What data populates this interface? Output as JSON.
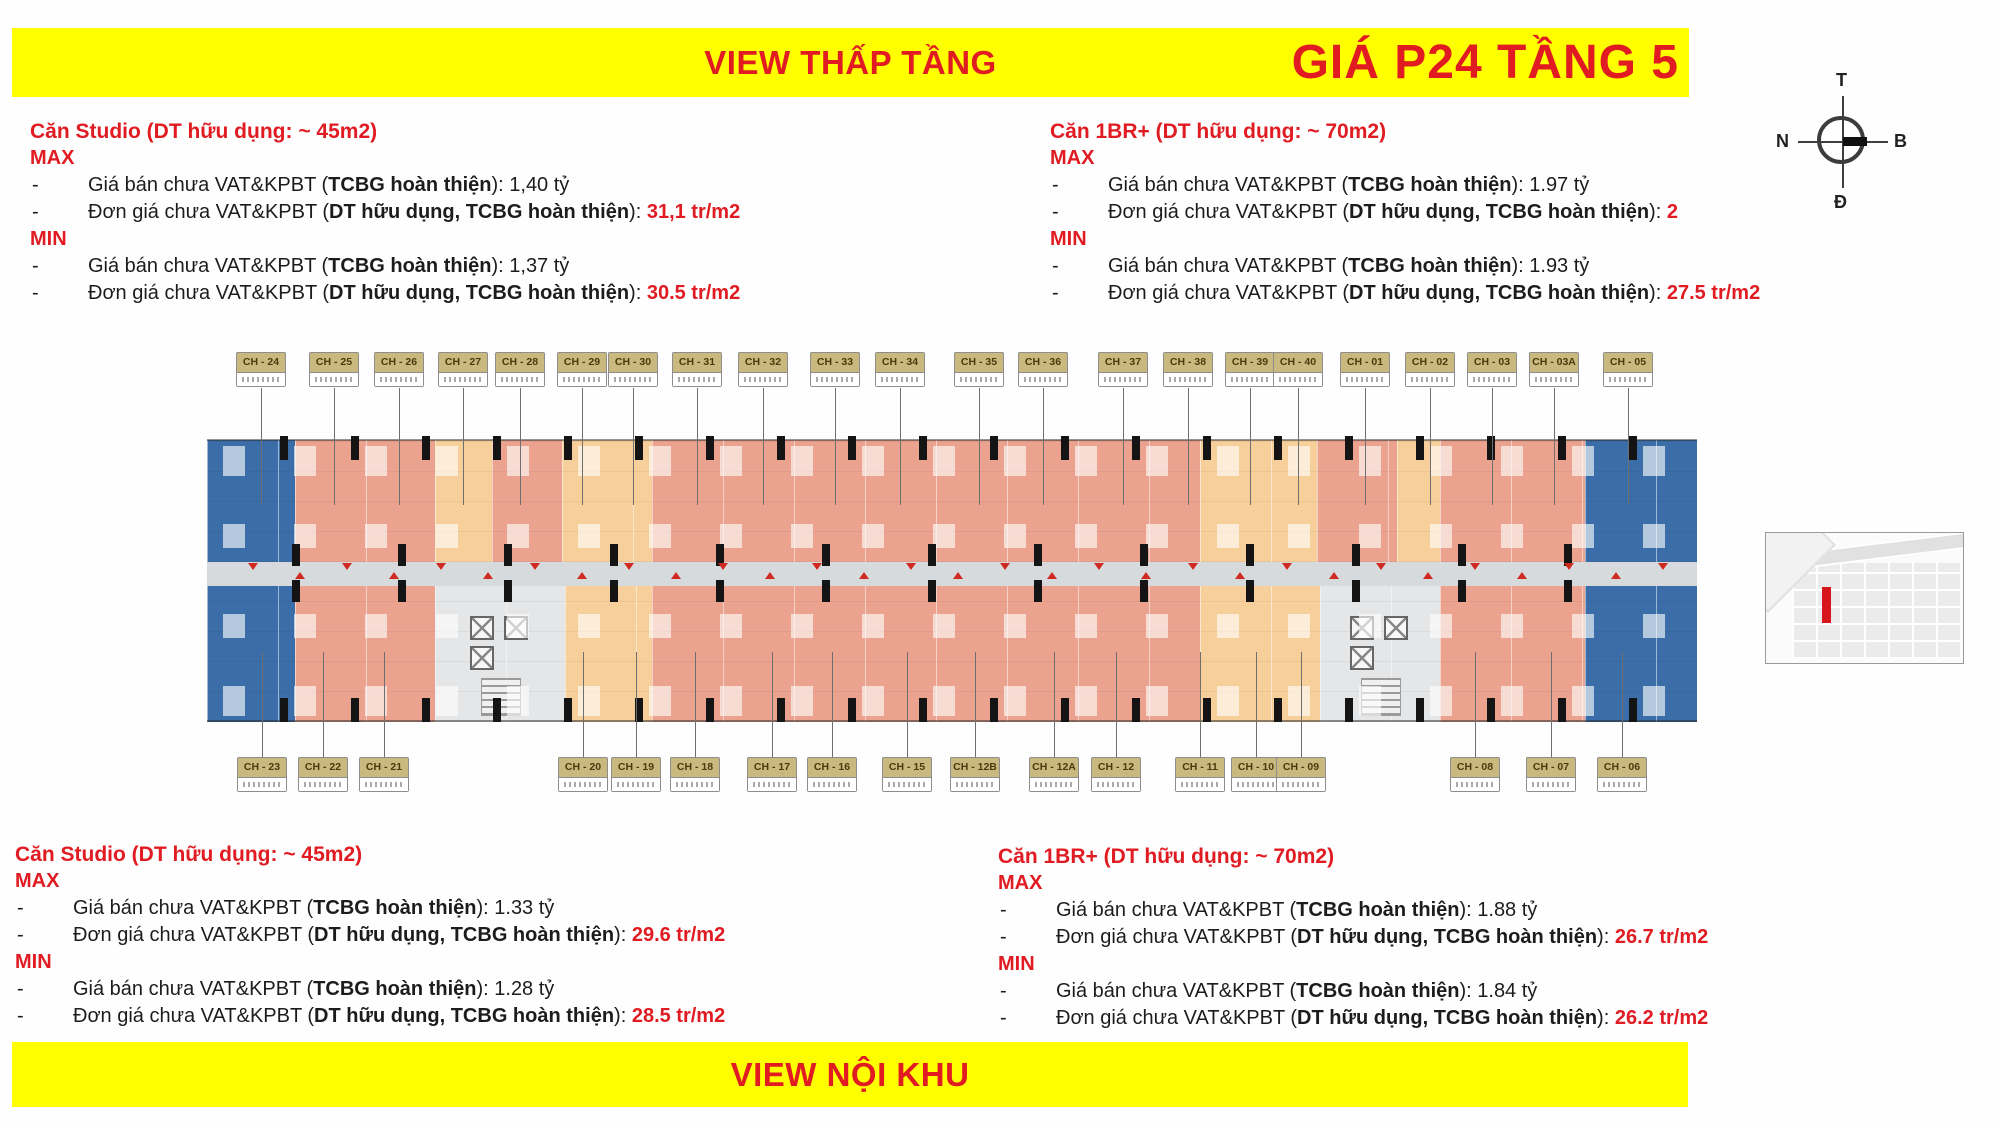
{
  "banners": {
    "top_center": "VIEW THẤP TẦNG",
    "top_right": "GIÁ P24 TẦNG 5",
    "bottom_center": "VIEW NỘI KHU"
  },
  "compass": {
    "top": "T",
    "bottom": "Đ",
    "left": "N",
    "right": "B"
  },
  "pricing": {
    "bullet": "-",
    "blocks": [
      {
        "pos": "tl",
        "title": "Căn Studio (DT hữu dụng: ~ 45m2)",
        "groups": [
          {
            "label": "MAX",
            "rows": [
              [
                [
                  "Giá bán chưa VAT&KPBT (",
                  ""
                ],
                [
                  "TCBG hoàn thiện",
                  "b"
                ],
                [
                  "): 1,40 tỷ",
                  ""
                ]
              ],
              [
                [
                  "Đơn giá chưa VAT&KPBT (",
                  ""
                ],
                [
                  "DT hữu dụng, TCBG hoàn thiện",
                  "b"
                ],
                [
                  "): ",
                  ""
                ],
                [
                  "31,1 tr/m2",
                  "r"
                ]
              ]
            ]
          },
          {
            "label": "MIN",
            "rows": [
              [
                [
                  "Giá bán chưa VAT&KPBT (",
                  ""
                ],
                [
                  "TCBG hoàn thiện",
                  "b"
                ],
                [
                  "): 1,37 tỷ",
                  ""
                ]
              ],
              [
                [
                  "Đơn giá chưa VAT&KPBT (",
                  ""
                ],
                [
                  "DT hữu dụng, TCBG hoàn thiện",
                  "b"
                ],
                [
                  "): ",
                  ""
                ],
                [
                  "30.5 tr/m2",
                  "r"
                ]
              ]
            ]
          }
        ]
      },
      {
        "pos": "tr",
        "title": "Căn 1BR+ (DT hữu dụng: ~ 70m2)",
        "groups": [
          {
            "label": "MAX",
            "rows": [
              [
                [
                  "Giá bán chưa VAT&KPBT (",
                  ""
                ],
                [
                  "TCBG hoàn thiện",
                  "b"
                ],
                [
                  "): 1.97 tỷ",
                  ""
                ]
              ],
              [
                [
                  "Đơn giá chưa VAT&KPBT (",
                  ""
                ],
                [
                  "DT hữu dụng, TCBG hoàn thiện",
                  "b"
                ],
                [
                  "): ",
                  ""
                ],
                [
                  "2",
                  "r"
                ]
              ]
            ]
          },
          {
            "label": "MIN",
            "rows": [
              [
                [
                  "Giá bán chưa VAT&KPBT (",
                  ""
                ],
                [
                  "TCBG hoàn thiện",
                  "b"
                ],
                [
                  "): 1.93 tỷ",
                  ""
                ]
              ],
              [
                [
                  "Đơn giá chưa VAT&KPBT (",
                  ""
                ],
                [
                  "DT hữu dụng, TCBG hoàn thiện",
                  "b"
                ],
                [
                  "): ",
                  ""
                ],
                [
                  "27.5 tr/m2",
                  "r"
                ]
              ]
            ]
          }
        ]
      },
      {
        "pos": "bl",
        "title": "Căn Studio (DT hữu dụng: ~ 45m2)",
        "groups": [
          {
            "label": "MAX",
            "rows": [
              [
                [
                  "Giá bán chưa VAT&KPBT (",
                  ""
                ],
                [
                  "TCBG hoàn thiện",
                  "b"
                ],
                [
                  "): 1.33 tỷ",
                  ""
                ]
              ],
              [
                [
                  "Đơn giá chưa VAT&KPBT (",
                  ""
                ],
                [
                  "DT hữu dụng, TCBG hoàn thiện",
                  "b"
                ],
                [
                  "): ",
                  ""
                ],
                [
                  "29.6 tr/m2",
                  "r"
                ]
              ]
            ]
          },
          {
            "label": "MIN",
            "rows": [
              [
                [
                  "Giá bán chưa VAT&KPBT (",
                  ""
                ],
                [
                  "TCBG hoàn thiện",
                  "b"
                ],
                [
                  "): 1.28 tỷ",
                  ""
                ]
              ],
              [
                [
                  "Đơn giá chưa VAT&KPBT (",
                  ""
                ],
                [
                  "DT hữu dụng, TCBG hoàn thiện",
                  "b"
                ],
                [
                  "): ",
                  ""
                ],
                [
                  "28.5 tr/m2",
                  "r"
                ]
              ]
            ]
          }
        ]
      },
      {
        "pos": "brp",
        "title": "Căn 1BR+ (DT hữu dụng: ~ 70m2)",
        "groups": [
          {
            "label": "MAX",
            "rows": [
              [
                [
                  "Giá bán chưa VAT&KPBT (",
                  ""
                ],
                [
                  "TCBG hoàn thiện",
                  "b"
                ],
                [
                  "): 1.88 tỷ",
                  ""
                ]
              ],
              [
                [
                  "Đơn giá chưa VAT&KPBT (",
                  ""
                ],
                [
                  "DT hữu dụng, TCBG hoàn thiện",
                  "b"
                ],
                [
                  ")",
                  ""
                ],
                [
                  ": ",
                  ""
                ],
                [
                  "26.7 tr/m2",
                  "r"
                ]
              ]
            ]
          },
          {
            "label": "MIN",
            "rows": [
              [
                [
                  "Giá bán chưa VAT&KPBT (",
                  ""
                ],
                [
                  "TCBG hoàn thiện",
                  "b"
                ],
                [
                  "): 1.84 tỷ",
                  ""
                ]
              ],
              [
                [
                  "Đơn giá chưa VAT&KPBT (",
                  ""
                ],
                [
                  "DT hữu dụng, TCBG hoàn thiện",
                  "b"
                ],
                [
                  ")",
                  ""
                ],
                [
                  ": ",
                  ""
                ],
                [
                  "26.2 tr/m2",
                  "r"
                ]
              ]
            ]
          }
        ]
      }
    ]
  },
  "floor_plan": {
    "colors": {
      "salmon": "#EBA28F",
      "orange": "#F6CF9B",
      "blue": "#3B6EA8",
      "core": "#E4E6E7",
      "corridor": "#D7DADC",
      "label_bg": "#C9B97E",
      "accent_red": "#E01B22",
      "banner_yellow": "#FFFF00"
    },
    "top_sections": [
      [
        "blue",
        207,
        295
      ],
      [
        "salmon",
        295,
        435
      ],
      [
        "orange",
        435,
        492
      ],
      [
        "salmon",
        492,
        562
      ],
      [
        "orange",
        562,
        652
      ],
      [
        "salmon",
        652,
        1200
      ],
      [
        "orange",
        1200,
        1317
      ],
      [
        "salmon",
        1317,
        1397
      ],
      [
        "orange",
        1397,
        1440
      ],
      [
        "salmon",
        1440,
        1585
      ],
      [
        "blue",
        1585,
        1697
      ]
    ],
    "bottom_sections": [
      [
        "blue",
        207,
        295
      ],
      [
        "salmon",
        295,
        435
      ],
      [
        "core",
        435,
        565
      ],
      [
        "orange",
        565,
        652
      ],
      [
        "salmon",
        652,
        1200
      ],
      [
        "orange",
        1200,
        1320
      ],
      [
        "core",
        1320,
        1440
      ],
      [
        "salmon",
        1440,
        1585
      ],
      [
        "blue",
        1585,
        1697
      ]
    ],
    "top_labels": [
      {
        "label": "CH - 24",
        "x": 261
      },
      {
        "label": "CH - 25",
        "x": 334
      },
      {
        "label": "CH - 26",
        "x": 399
      },
      {
        "label": "CH - 27",
        "x": 463
      },
      {
        "label": "CH - 28",
        "x": 520
      },
      {
        "label": "CH - 29",
        "x": 582
      },
      {
        "label": "CH - 30",
        "x": 633
      },
      {
        "label": "CH - 31",
        "x": 697
      },
      {
        "label": "CH - 32",
        "x": 763
      },
      {
        "label": "CH - 33",
        "x": 835
      },
      {
        "label": "CH - 34",
        "x": 900
      },
      {
        "label": "CH - 35",
        "x": 979
      },
      {
        "label": "CH - 36",
        "x": 1043
      },
      {
        "label": "CH - 37",
        "x": 1123
      },
      {
        "label": "CH - 38",
        "x": 1188
      },
      {
        "label": "CH - 39",
        "x": 1250
      },
      {
        "label": "CH - 40",
        "x": 1298
      },
      {
        "label": "CH - 01",
        "x": 1365
      },
      {
        "label": "CH - 02",
        "x": 1430
      },
      {
        "label": "CH - 03",
        "x": 1492
      },
      {
        "label": "CH - 03A",
        "x": 1554
      },
      {
        "label": "CH - 05",
        "x": 1628
      }
    ],
    "bottom_labels": [
      {
        "label": "CH - 23",
        "x": 262
      },
      {
        "label": "CH - 22",
        "x": 323
      },
      {
        "label": "CH - 21",
        "x": 384
      },
      {
        "label": "CH - 20",
        "x": 583
      },
      {
        "label": "CH - 19",
        "x": 636
      },
      {
        "label": "CH - 18",
        "x": 695
      },
      {
        "label": "CH - 17",
        "x": 772
      },
      {
        "label": "CH - 16",
        "x": 832
      },
      {
        "label": "CH - 15",
        "x": 907
      },
      {
        "label": "CH - 12B",
        "x": 975
      },
      {
        "label": "CH - 12A",
        "x": 1054
      },
      {
        "label": "CH - 12",
        "x": 1116
      },
      {
        "label": "CH - 11",
        "x": 1200
      },
      {
        "label": "CH - 10",
        "x": 1256
      },
      {
        "label": "CH - 09",
        "x": 1301
      },
      {
        "label": "CH - 08",
        "x": 1475
      },
      {
        "label": "CH - 07",
        "x": 1551
      },
      {
        "label": "CH - 06",
        "x": 1622
      }
    ]
  }
}
